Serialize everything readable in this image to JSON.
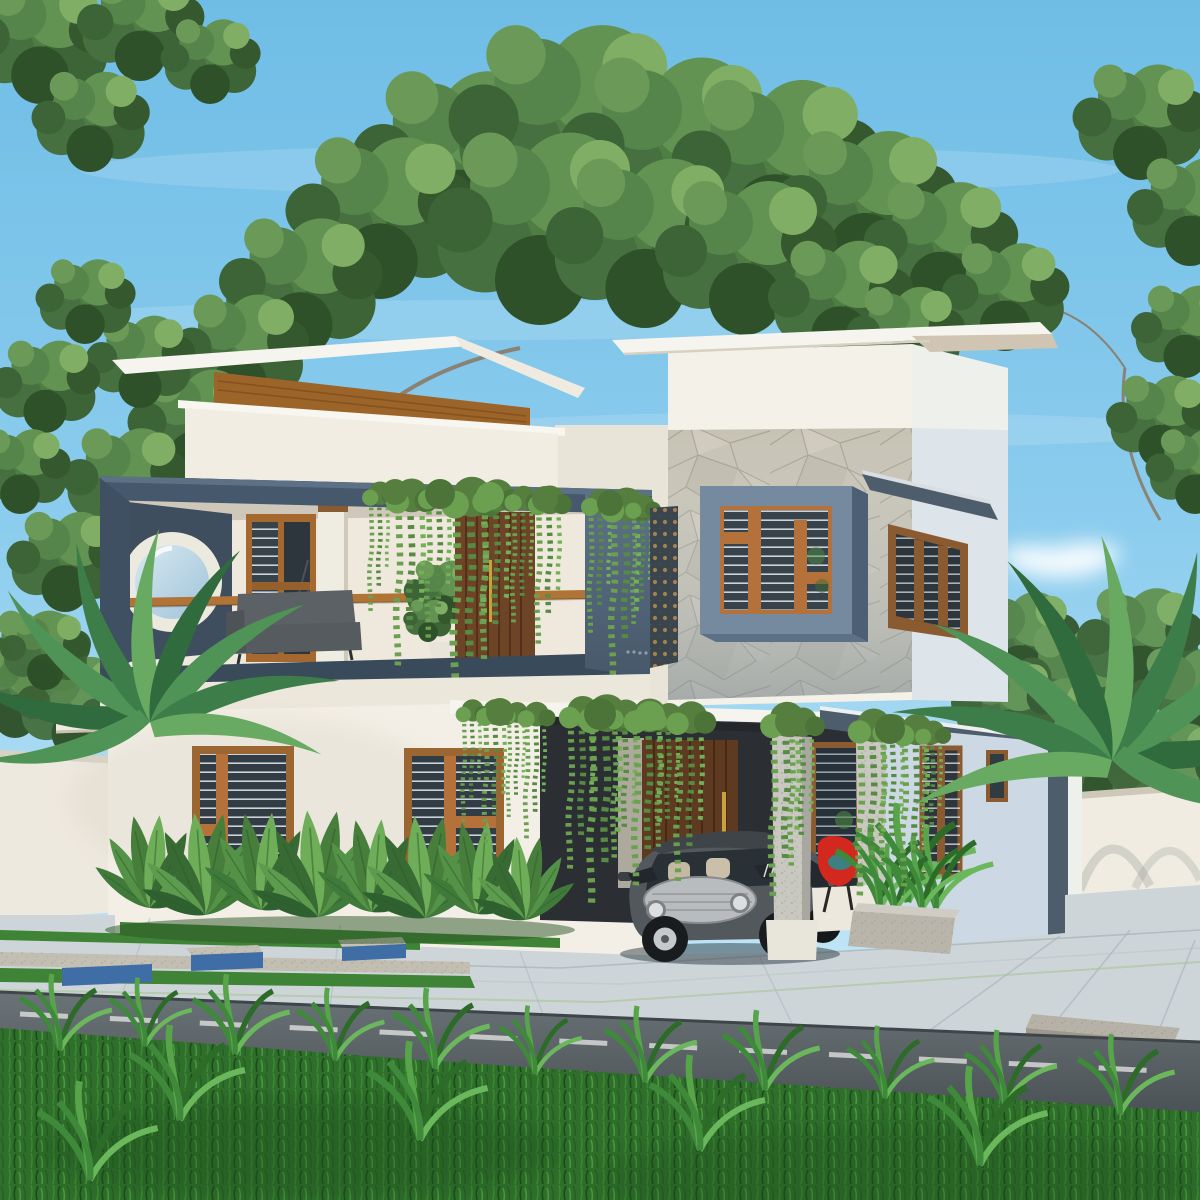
{
  "scene": {
    "type": "architectural-exterior-3d-render",
    "subject": "modern-two-storey-villa-with-carport",
    "objects": [
      "sky",
      "clouds",
      "tree-canopy",
      "tree-branches",
      "hedge",
      "compound-wall",
      "flat-roof-slab",
      "wood-fascia",
      "balcony",
      "porthole-window",
      "balcony-railing",
      "outdoor-sofa",
      "potted-plant",
      "wood-glass-door",
      "tall-wood-door",
      "stone-feature-wall",
      "box-frame-window",
      "jali-screen",
      "side-awning-window",
      "ground-floor-window",
      "carport-roof",
      "main-entrance-door",
      "concrete-pillar",
      "hanging-vines",
      "hatchback-car",
      "red-chair",
      "concrete-planter",
      "banana-plants",
      "palm-plant",
      "paved-driveway",
      "lawn-strips",
      "curb-blocks",
      "granite-blocks",
      "asphalt-road",
      "road-center-line",
      "foreground-grass"
    ],
    "colors": {
      "sky_top": "#6fbde6",
      "sky_horizon": "#d6eef8",
      "cloud": "#ffffff",
      "foliage_dark": "#35582f",
      "foliage_mid": "#4f7d43",
      "foliage_light": "#7fae64",
      "branch": "#8a7f6f",
      "wall_white": "#f3efe6",
      "wall_shade": "#ddd8cb",
      "wall_blue": "#ccd8e3",
      "roof_white": "#f6f4ee",
      "roof_underside": "#cfc5b2",
      "wood_fascia": "#9c6428",
      "wood_frame": "#9c6632",
      "wood_door_dark": "#5e3a20",
      "railing_wood": "#b07437",
      "balcony_frame": "#46586c",
      "balcony_frame_dark": "#394a5b",
      "balcony_panel": "#53657a",
      "stone_base": "#c6c2b4",
      "window_box_frame": "#75899f",
      "glass_dark": "#37424a",
      "blind_line": "#e8eef2",
      "jali_bronze": "#b08850",
      "sofa_gray": "#5c6165",
      "pillar_concrete": "#c9c8c0",
      "car_body": "#53585d",
      "car_grille": "#b9bcbe",
      "chair_red": "#d2281e",
      "planter_concrete": "#b9b5ab",
      "pavement": "#cdd5d9",
      "curb_blue": "#3f6da5",
      "granite_block": "#b7b2a8",
      "road_asphalt": "#5a6266",
      "road_marking": "#e8e8e6",
      "grass_base": "#2f6e2b",
      "grass_light": "#499540"
    }
  }
}
